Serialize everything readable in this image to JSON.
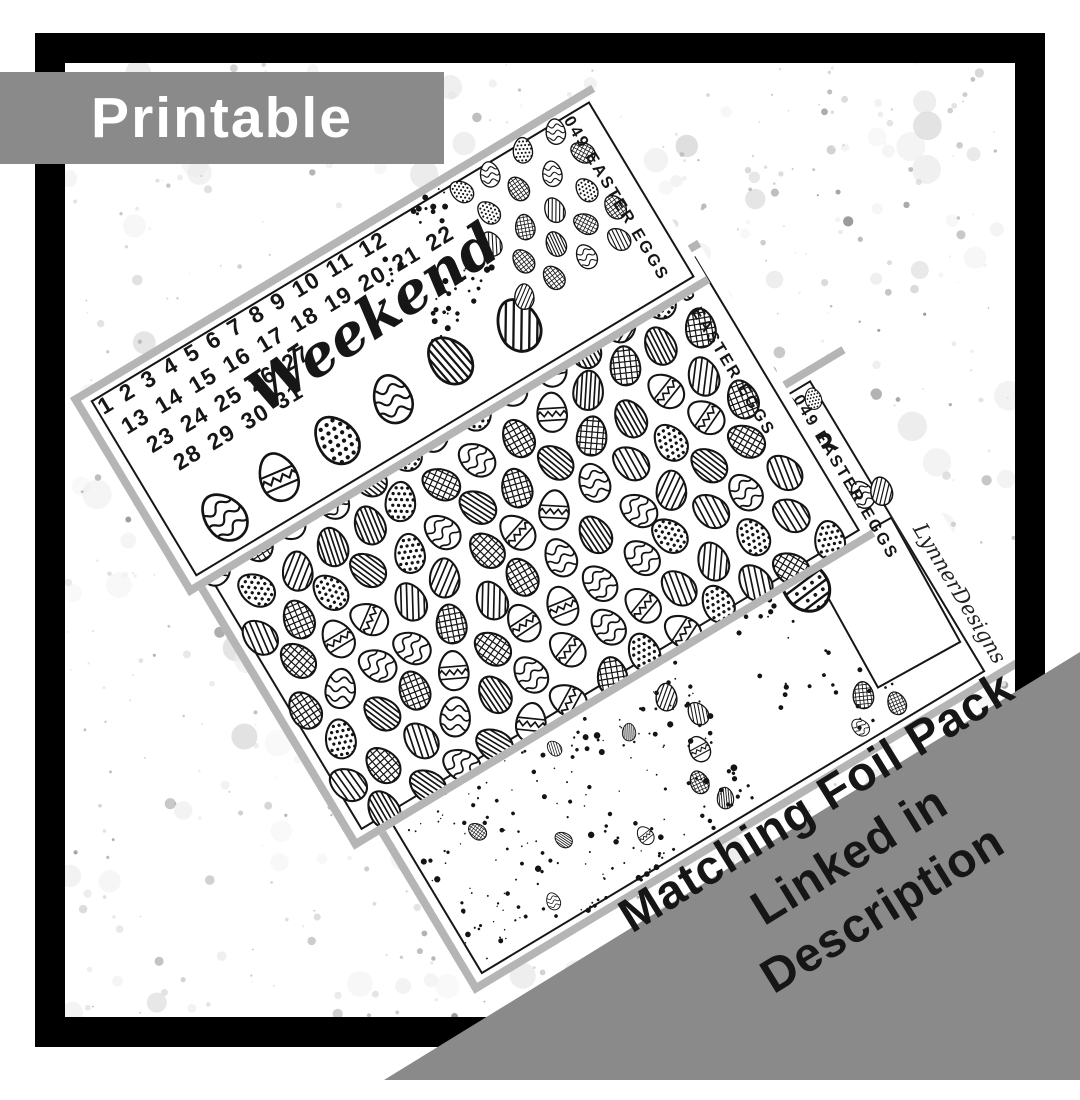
{
  "badge": {
    "label": "Printable"
  },
  "sheets": {
    "code_label": "049 EASTER EGGS",
    "sheet1": {
      "date_rows": [
        "1 2 3 4 5 6 7 8 9 10 11 12",
        "13 14 15 16 17 18 19 20 21 22",
        "23 24 25 26 27",
        "28 29 30 31"
      ],
      "weekend_label": "Weekend"
    },
    "sheet3": {
      "greeting_line1": "HAPPY",
      "greeting_line2": "EASTER",
      "brand": "LynnerDesigns"
    }
  },
  "ribbon": {
    "lines": [
      "Matching Foil Pack",
      "Linked in",
      "Description"
    ]
  },
  "colors": {
    "banner_gray": "#8a8a8a",
    "frame_black": "#000000",
    "ink": "#161616",
    "paper": "#ffffff",
    "edge_gray": "#b5b5b5"
  }
}
